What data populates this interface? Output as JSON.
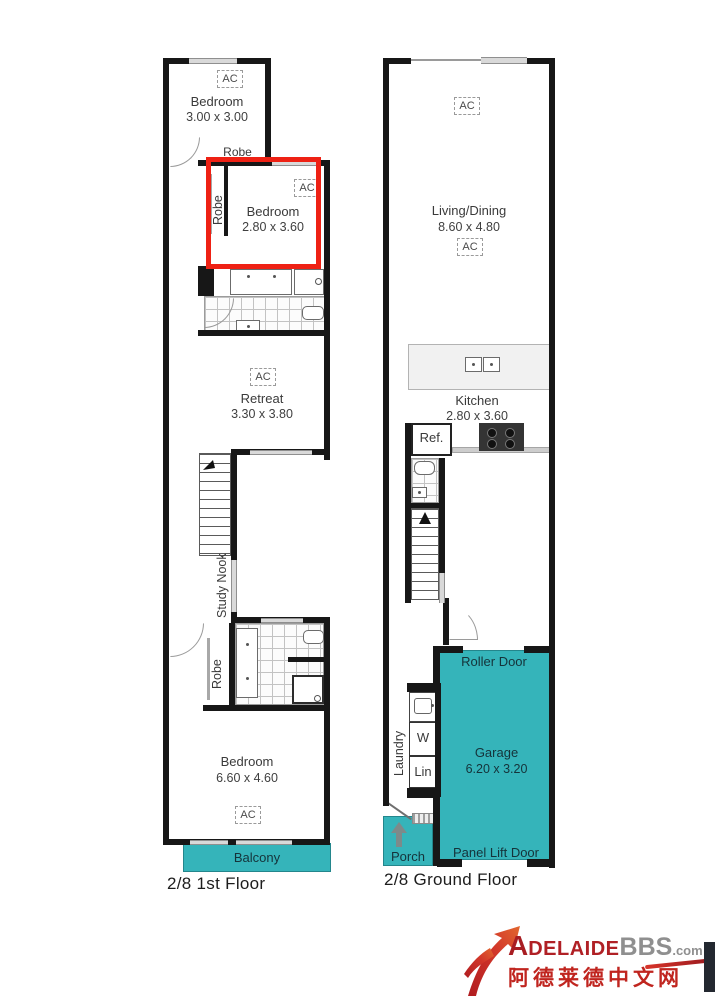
{
  "first_floor": {
    "label": "2/8 1st Floor",
    "bedroom_top": {
      "name": "Bedroom",
      "dims": "3.00 x 3.00"
    },
    "bedroom_mid": {
      "name": "Bedroom",
      "dims": "2.80 x 3.60"
    },
    "retreat": {
      "name": "Retreat",
      "dims": "3.30 x 3.80"
    },
    "bedroom_main": {
      "name": "Bedroom",
      "dims": "6.60 x 4.60"
    },
    "robe_top": "Robe",
    "robe_mid": "Robe",
    "robe_lower": "Robe",
    "study_nook": "Study Nook",
    "balcony": "Balcony"
  },
  "ground_floor": {
    "label": "2/8 Ground Floor",
    "living_dining": {
      "name": "Living/Dining",
      "dims": "8.60 x 4.80"
    },
    "kitchen": {
      "name": "Kitchen",
      "dims": "2.80 x 3.60"
    },
    "garage": {
      "name": "Garage",
      "dims": "6.20 x 3.20"
    },
    "fridge": "Ref.",
    "laundry": "Laundry",
    "washer": "W",
    "linen": "Lin",
    "porch": "Porch",
    "roller_door": "Roller Door",
    "panel_lift_door": "Panel Lift Door"
  },
  "ac_label": "AC",
  "watermark": {
    "brand_initial": "A",
    "brand_rest": "DELAIDE",
    "brand_bbs": "BBS",
    "brand_tld": ".com",
    "chinese": "阿德莱德中文网"
  },
  "colors": {
    "teal": "#35b4ba",
    "highlight_red": "#ee2114",
    "wall_black": "#171717"
  }
}
